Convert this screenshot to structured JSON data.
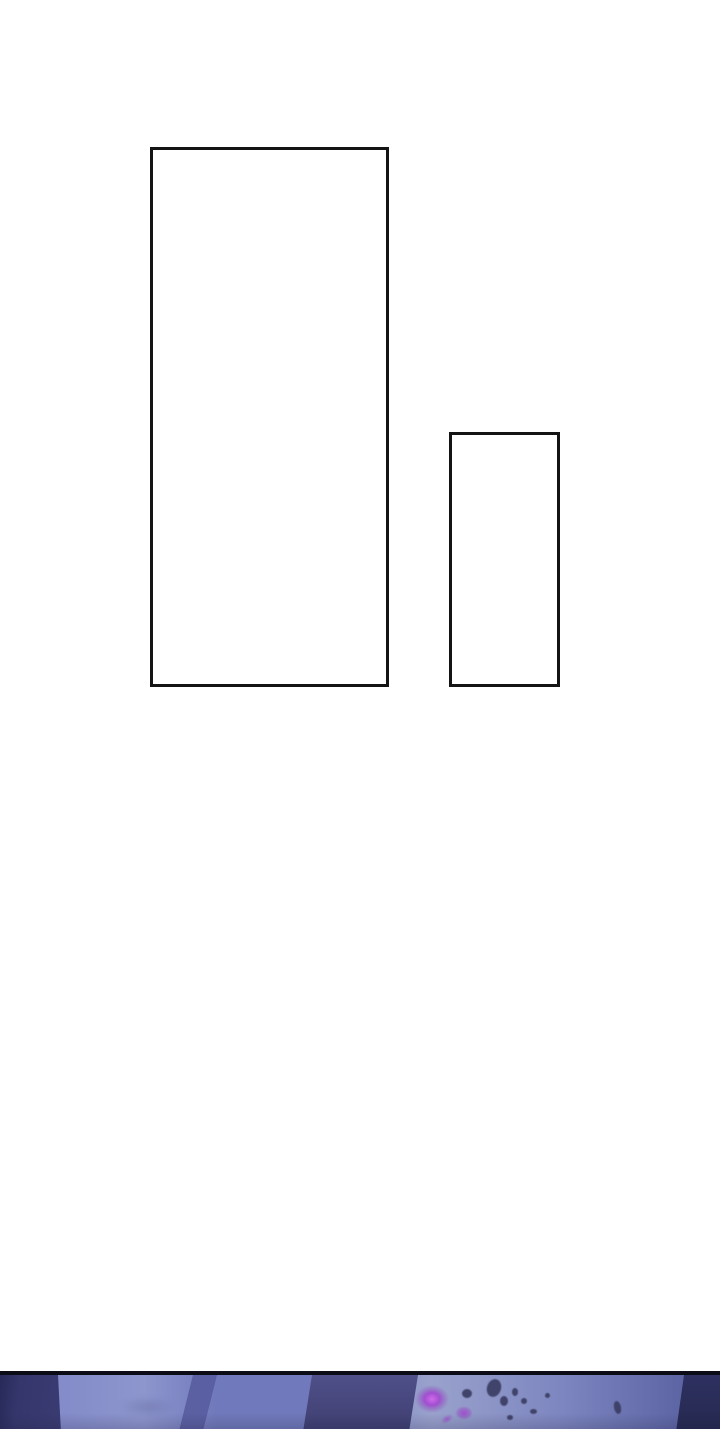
{
  "page": {
    "type": "webtoon-comic-page",
    "visible_text": ""
  },
  "panels": {
    "large_panel": {
      "content": "",
      "state": "empty"
    },
    "small_panel": {
      "content": "",
      "state": "empty"
    }
  },
  "bottom_artwork": {
    "description": "partial next panel: dark indigo crystal shards and planes with magenta glow specks and floating debris"
  },
  "colors": {
    "page_bg": "#ffffff",
    "panel_border": "#141414",
    "divider": "#0c0c16",
    "base_a": "#838bc9",
    "base_b": "#8e96ce",
    "base_c": "#7079bb",
    "base_d": "#99a1cc",
    "base_e": "#5c64a4",
    "dark_left_a": "#252755",
    "dark_left_b": "#35366c",
    "band": "#565c9e",
    "column_a": "#50508a",
    "column_b": "#3f3f72",
    "far_right_a": "#2e3160",
    "far_right_b": "#252950",
    "glow_a": "#d06ae9",
    "glow_b": "#a04fd0",
    "speck": "#3a3d63"
  }
}
